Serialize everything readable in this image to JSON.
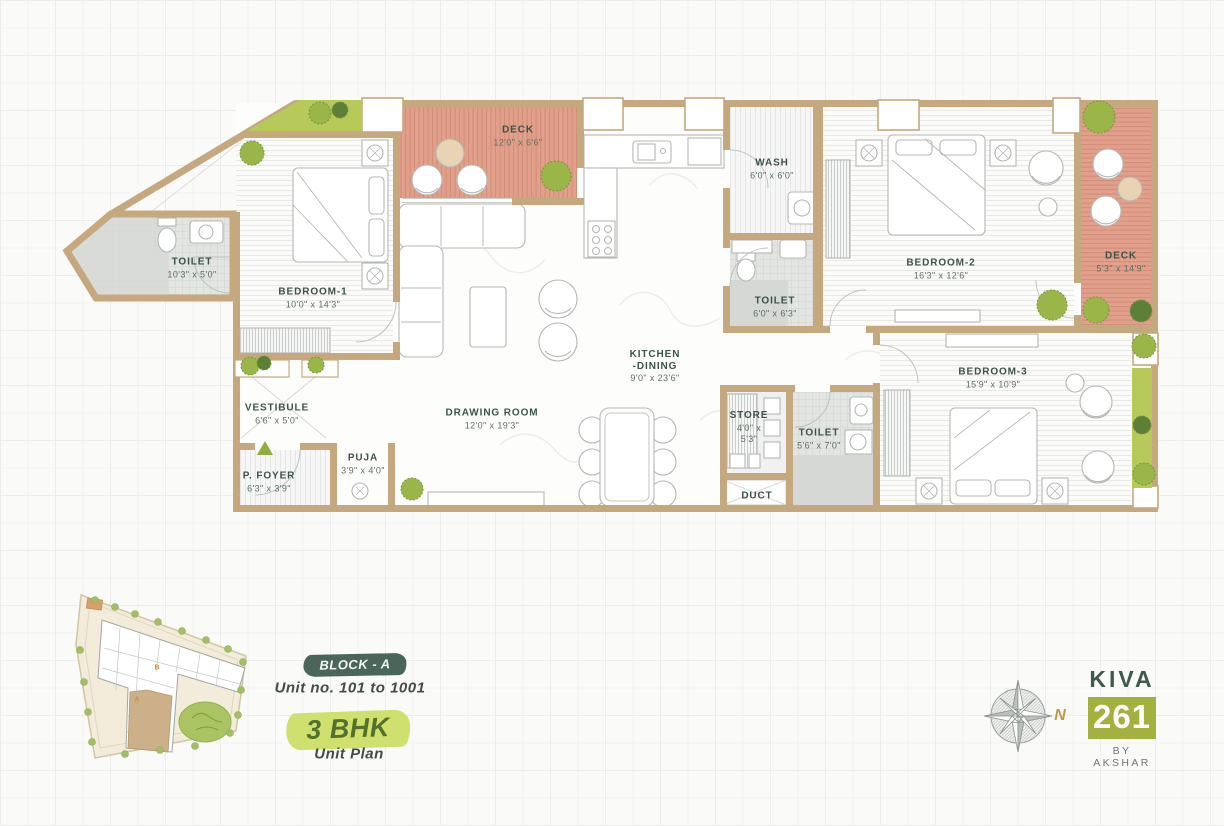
{
  "plan": {
    "rooms": {
      "toilet1": {
        "name": "TOILET",
        "dims": "10'3\" x 5'0\""
      },
      "bedroom1": {
        "name": "BEDROOM-1",
        "dims": "10'0\" x 14'3\""
      },
      "deck_top": {
        "name": "DECK",
        "dims": "12'0\" x 6'6\""
      },
      "wash": {
        "name": "WASH",
        "dims": "6'0\" x 6'0\""
      },
      "toilet2": {
        "name": "TOILET",
        "dims": "6'0\" x 6'3\""
      },
      "bedroom2": {
        "name": "BEDROOM-2",
        "dims": "16'3\" x 12'6\""
      },
      "deck_right": {
        "name": "DECK",
        "dims": "5'3\" x 14'9\""
      },
      "kitchen": {
        "name": "KITCHEN",
        "name2": "-DINING",
        "dims": "9'0\" x 23'6\""
      },
      "bedroom3": {
        "name": "BEDROOM-3",
        "dims": "15'9\" x 10'9\""
      },
      "drawing": {
        "name": "DRAWING ROOM",
        "dims": "12'0\" x 19'3\""
      },
      "vestibule": {
        "name": "VESTIBULE",
        "dims": "6'6\" x 5'0\""
      },
      "puja": {
        "name": "PUJA",
        "dims": "3'9\" x 4'0\""
      },
      "pfoyer": {
        "name": "P. FOYER",
        "dims": "6'3\" x 3'9\""
      },
      "store": {
        "name": "STORE",
        "dims": "4'0\" x",
        "dims2": "5'3\""
      },
      "toilet3": {
        "name": "TOILET",
        "dims": "5'6\" x 7'0\""
      },
      "duct": {
        "name": "DUCT"
      }
    }
  },
  "annotations": {
    "block_badge": "BLOCK - A",
    "unit_range": "Unit no. 101 to 1001",
    "bhk_badge": "3 BHK",
    "plan_type": "Unit Plan"
  },
  "brand": {
    "name": "KIVA",
    "number": "261",
    "byline": "BY AKSHAR"
  },
  "compass": {
    "north": "N"
  },
  "site_plan": {
    "label_a": "A",
    "label_b": "B"
  },
  "colors": {
    "wall": "#c6a87f",
    "deck": "#e2a08c",
    "planter_green": "#a9c255",
    "label_text": "#3b5349",
    "badge_dark": "#4a665b",
    "badge_green": "#cfe06e",
    "brand_green": "#3c5a4d",
    "brand_box": "#a4b13f",
    "north_gold": "#c09a42"
  }
}
